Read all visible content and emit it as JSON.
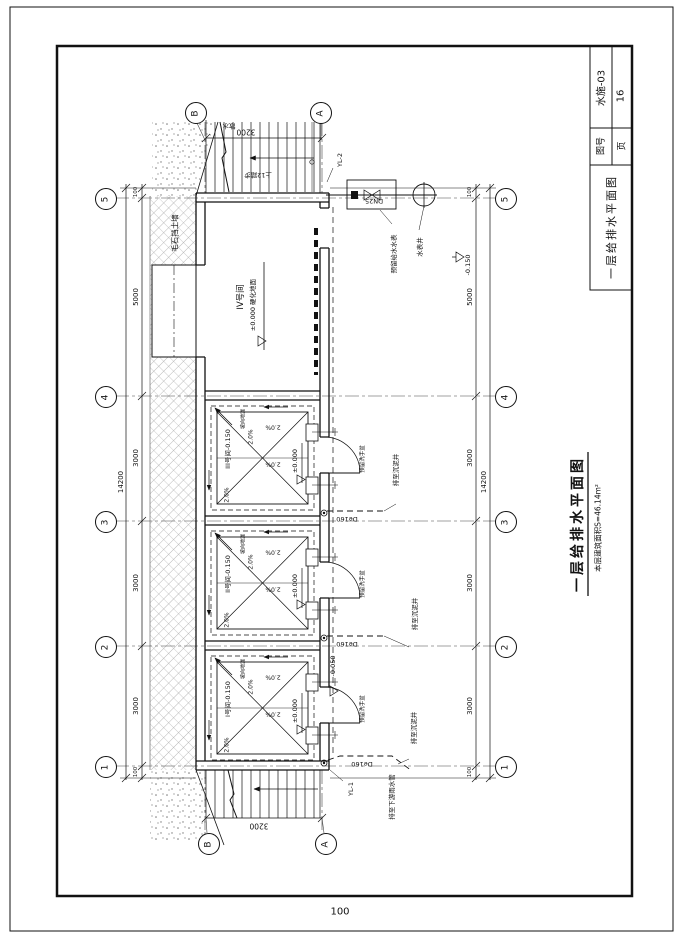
{
  "sheet": {
    "page_number": "100"
  },
  "title_block": {
    "drawing_no_label": "图号",
    "drawing_no": "水施-03",
    "page_label": "页",
    "page_no": "16",
    "title": "一层给排水平面图"
  },
  "drawing": {
    "title": "一层给排水平面图",
    "area_note": "本层建筑面积S=46.14m²",
    "rooms": {
      "room4": {
        "tag": "IV号间",
        "level_note": "±0.000 硬化地面"
      },
      "room3": {
        "tag": "III号间-0.150"
      },
      "room2": {
        "tag": "II号间-0.150"
      },
      "room1": {
        "tag": "I号间-0.150"
      },
      "slope": "2.0%",
      "datum": "±0.000",
      "slope_note": "坡向地漏",
      "door_note": "预留洗手盆"
    },
    "notes": {
      "retaining_wall": "毛石挡土墙",
      "apron": "散水",
      "stair_note": "上12踏步",
      "reserved_meter": "预留给水水表",
      "meter_well": "水表井",
      "pipe_size": "DN25",
      "rain_leader_2": "YL-2",
      "rain_leader_1": "YL-1",
      "drain_size": "De160",
      "to_silt_well": "排至沉泥井",
      "to_rain_pipe": "排至下游雨水管",
      "outdoor_level": "-0.150",
      "entry_level": "-0.050"
    },
    "axes": {
      "left": [
        "5",
        "4",
        "3",
        "2",
        "1"
      ],
      "right": [
        "5",
        "4",
        "3",
        "2",
        "1"
      ],
      "top": [
        "B",
        "A"
      ],
      "bottom": [
        "B",
        "A"
      ]
    },
    "dims": {
      "left_chain": [
        "100",
        "5000",
        "3000",
        "3000",
        "3000",
        "100"
      ],
      "left_total": "14200",
      "right_chain": [
        "100",
        "5000",
        "3000",
        "3000",
        "3000",
        "100"
      ],
      "right_total": "14200",
      "top_width": "3200",
      "bottom_width": "3200"
    }
  }
}
